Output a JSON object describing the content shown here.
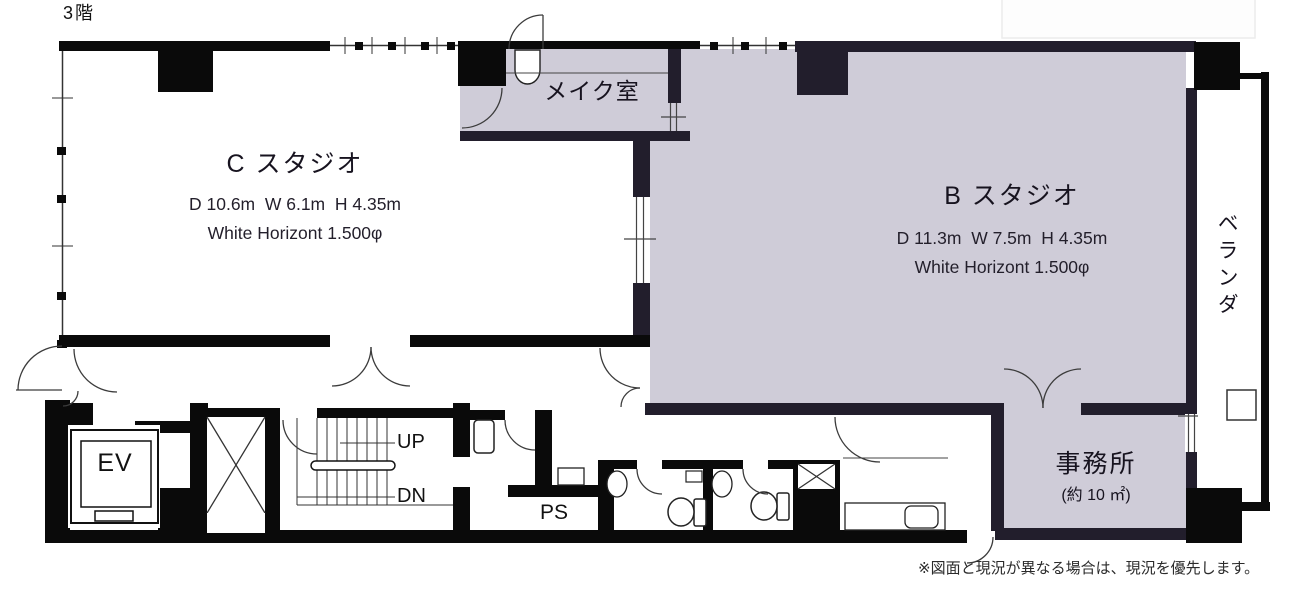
{
  "meta": {
    "floor_label": "3階",
    "note": "※図面と現況が異なる場合は、現況を優先します。"
  },
  "rooms": {
    "c_studio": {
      "name": "C スタジオ",
      "dims": "D 10.6m  W 6.1m  H 4.35m",
      "spec": "White Horizont 1.500φ"
    },
    "b_studio": {
      "name": "B スタジオ",
      "dims": "D 11.3m  W 7.5m  H 4.35m",
      "spec": "White Horizont 1.500φ"
    },
    "makeup": {
      "name": "メイク室"
    },
    "veranda": {
      "name": "ベランダ"
    },
    "office": {
      "name": "事務所",
      "area": "(約 10 ㎡)"
    },
    "elevator": {
      "label": "EV"
    },
    "stairs": {
      "up": "UP",
      "down": "DN"
    },
    "pipe_space": {
      "label": "PS"
    }
  },
  "colors": {
    "room_highlight": "#cfccd8",
    "wall_navy": "#221e2c",
    "wall_black": "#0a0a0a",
    "door_stroke": "#3c3c3c"
  }
}
